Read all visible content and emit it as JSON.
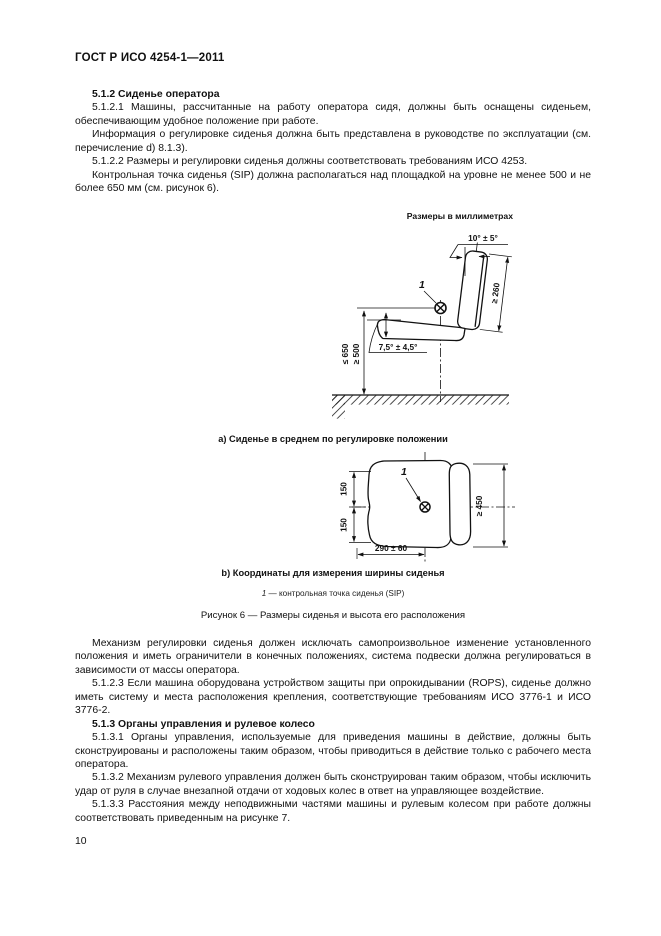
{
  "page": {
    "header": "ГОСТ Р ИСО 4254-1—2011",
    "page_number": "10"
  },
  "content": {
    "before_figure": [
      "5.1.2 Сиденье оператора",
      "5.1.2.1 Машины, рассчитанные на работу оператора сидя, должны быть оснащены сиденьем, обеспечивающим удобное положение при работе.",
      "Информация о регулировке сиденья должна быть представлена в руководстве по эксплуатации (см. перечисление d) 8.1.3).",
      "5.1.2.2 Размеры и регулировки сиденья должны соответствовать требованиям ИСО 4253.",
      "Контрольная точка сиденья (SIP) должна располагаться над площадкой на уровне не менее 500 и не более 650 мм (см. рисунок 6)."
    ],
    "after_figure": [
      "Механизм регулировки сиденья должен исключать самопроизвольное изменение установленного положения и иметь ограничители в конечных положениях, система подвески должна регулироваться в зависимости от массы оператора.",
      "5.1.2.3 Если машина оборудована устройством защиты при опрокидывании (ROPS), сиденье должно иметь систему и места расположения крепления, соответствующие требованиям ИСО 3776-1 и ИСО 3776-2.",
      "5.1.3 Органы управления и рулевое колесо",
      "5.1.3.1 Органы управления, используемые для приведения машины в действие, должны быть сконструированы и расположены таким образом, чтобы приводиться в действие только с рабочего места оператора.",
      "5.1.3.2 Механизм рулевого управления должен быть сконструирован таким образом, чтобы исключить удар от руля в случае внезапной отдачи от ходовых колес в ответ на управляющее воздействие.",
      "5.1.3.3 Расстояния между неподвижными частями машины и рулевым колесом при работе должны соответствовать приведенным на рисунке 7."
    ]
  },
  "figure6": {
    "units_note": "Размеры в миллиметрах",
    "view_a": {
      "caption": "а) Сиденье в среднем по регулировке положении",
      "labels": {
        "backrest_angle": "10° ± 5°",
        "point_ref": "1",
        "backrest_height": "≥ 260",
        "cushion_angle": "7,5° ± 4,5°",
        "sip_height_max": "≤ 650",
        "sip_height_min": "≥ 500"
      }
    },
    "view_b": {
      "caption": "b) Координаты для измерения ширины сиденья",
      "labels": {
        "point_ref": "1",
        "half_width_top": "150",
        "half_width_bottom": "150",
        "seat_width": "≥ 450",
        "sip_offset": "290 ± 60"
      }
    },
    "legend": {
      "ref": "1",
      "text": "— контрольная точка сиденья (SIP)"
    },
    "caption": "Рисунок 6 — Размеры сиденья и высота его расположения"
  }
}
